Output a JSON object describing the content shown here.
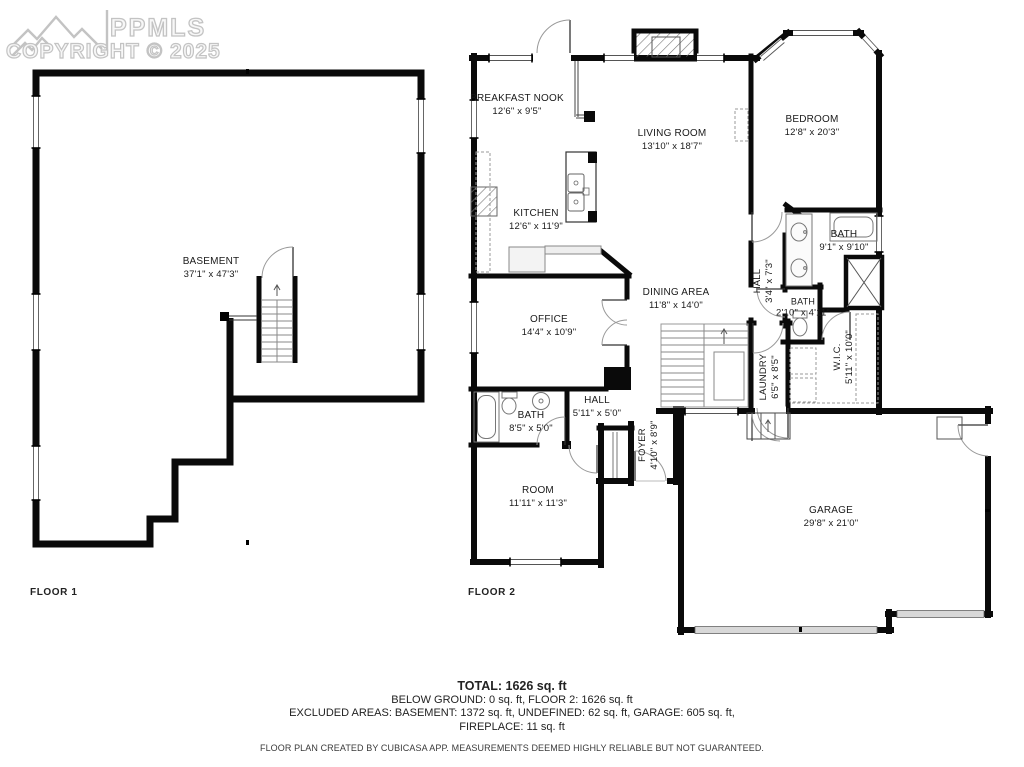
{
  "logo": {
    "brand": "PPMLS",
    "copyright": "COPYRIGHT © 2025",
    "icon": "mountains-icon"
  },
  "floor1": {
    "label": "FLOOR 1",
    "rooms": [
      {
        "name": "BASEMENT",
        "dims": "37'1\" x 47'3\""
      }
    ]
  },
  "floor2": {
    "label": "FLOOR 2",
    "rooms": [
      {
        "name": "BREAKFAST NOOK",
        "dims": "12'6\" x 9'5\""
      },
      {
        "name": "LIVING ROOM",
        "dims": "13'10\" x 18'7\""
      },
      {
        "name": "BEDROOM",
        "dims": "12'8\" x 20'3\""
      },
      {
        "name": "KITCHEN",
        "dims": "12'6\" x 11'9\""
      },
      {
        "name": "BATH",
        "dims": "9'1\" x 9'10\""
      },
      {
        "name": "DINING AREA",
        "dims": "11'8\" x 14'0\""
      },
      {
        "name": "HALL",
        "dims": "3'4\" x 7'3\""
      },
      {
        "name": "BATH",
        "dims": "2'10\" x 4'11\""
      },
      {
        "name": "OFFICE",
        "dims": "14'4\" x 10'9\""
      },
      {
        "name": "W.I.C.",
        "dims": "5'11\" x 10'0\""
      },
      {
        "name": "LAUNDRY",
        "dims": "6'5\" x 8'5\""
      },
      {
        "name": "HALL",
        "dims": "5'11\" x 5'0\""
      },
      {
        "name": "FOYER",
        "dims": "4'10\" x 8'9\""
      },
      {
        "name": "BATH",
        "dims": "8'5\" x 5'0\""
      },
      {
        "name": "ROOM",
        "dims": "11'11\" x 11'3\""
      },
      {
        "name": "GARAGE",
        "dims": "29'8\" x 21'0\""
      }
    ]
  },
  "summary": {
    "total": "TOTAL: 1626 sq. ft",
    "line2": "BELOW GROUND: 0 sq. ft, FLOOR 2: 1626 sq. ft",
    "line3": "EXCLUDED AREAS: BASEMENT: 1372 sq. ft, UNDEFINED: 62 sq. ft, GARAGE: 605 sq. ft,",
    "line4": "FIREPLACE: 11 sq. ft",
    "disclaimer": "FLOOR PLAN CREATED BY CUBICASA APP. MEASUREMENTS DEEMED HIGHLY RELIABLE BUT NOT GUARANTEED."
  }
}
